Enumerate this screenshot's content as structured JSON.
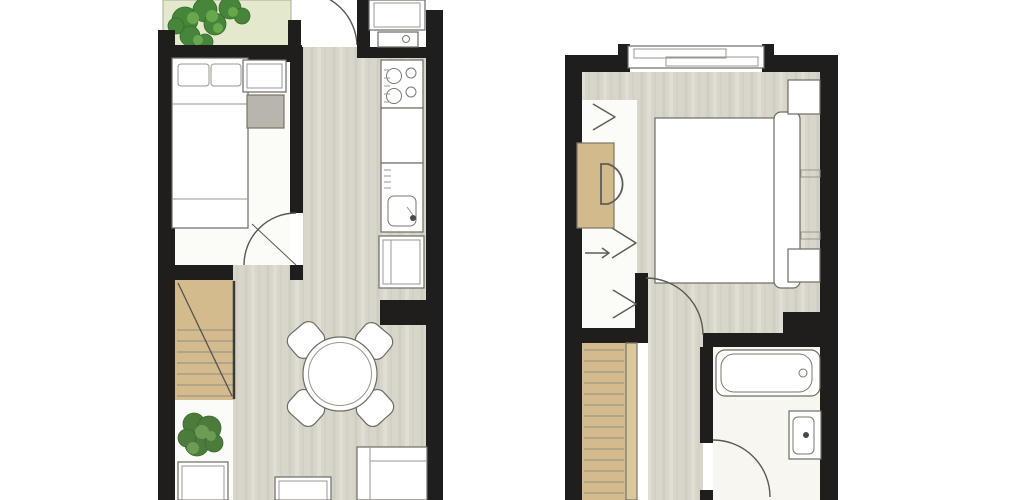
{
  "document": {
    "type": "architectural-floor-plan",
    "label": "Two-storey apartment floor plans, ground floor and upper floor, top-down view",
    "views": [
      {
        "id": "ground-floor",
        "position": "left"
      },
      {
        "id": "upper-floor",
        "position": "right"
      }
    ]
  },
  "colors": {
    "background": "#ffffff",
    "wall": "#1f1e1c",
    "wood_floor": "#d8d5cb",
    "white_floor": "#fbfbf8",
    "bathroom_floor": "#f7f6f1",
    "garden": "#e4e9cd",
    "shrub_dark": "#47853a",
    "shrub_light": "#67a84d",
    "stairs": "#d4bb8e",
    "stair_stringer": "#dcc89e",
    "desk": "#d3ba8c",
    "furniture_fill": "#ffffff",
    "side_table": "#b8b6ac",
    "plant_dark": "#4c7c3c",
    "plant_light": "#6d9c55",
    "fixture_dot": "#4a4942"
  },
  "ground_floor": {
    "rooms": [
      "garden-terrace",
      "bedroom",
      "entry-hall",
      "kitchen",
      "dining-living-area",
      "staircase-bay"
    ],
    "furniture": [
      "shrubs",
      "single-bed",
      "cabinet",
      "side-table",
      "staircase",
      "potted-plant",
      "sideboard",
      "round-dining-table",
      "dining-chairs-x4",
      "tall-kitchen-units",
      "stove",
      "kitchen-counter",
      "kitchen-sink",
      "base-cabinet",
      "sofa",
      "coffee-table"
    ],
    "doors": [
      "entrance-door",
      "bedroom-door"
    ]
  },
  "upper_floor": {
    "rooms": [
      "bedroom",
      "wardrobe-niche",
      "landing",
      "bathroom",
      "staircase"
    ],
    "furniture": [
      "window",
      "double-bed",
      "headboard",
      "nightstand-x2",
      "wall-shelves",
      "desk",
      "desk-chair",
      "wardrobe-chevrons",
      "staircase",
      "bathtub",
      "toilet"
    ],
    "doors": [
      "bedroom-door",
      "bathroom-door"
    ]
  }
}
